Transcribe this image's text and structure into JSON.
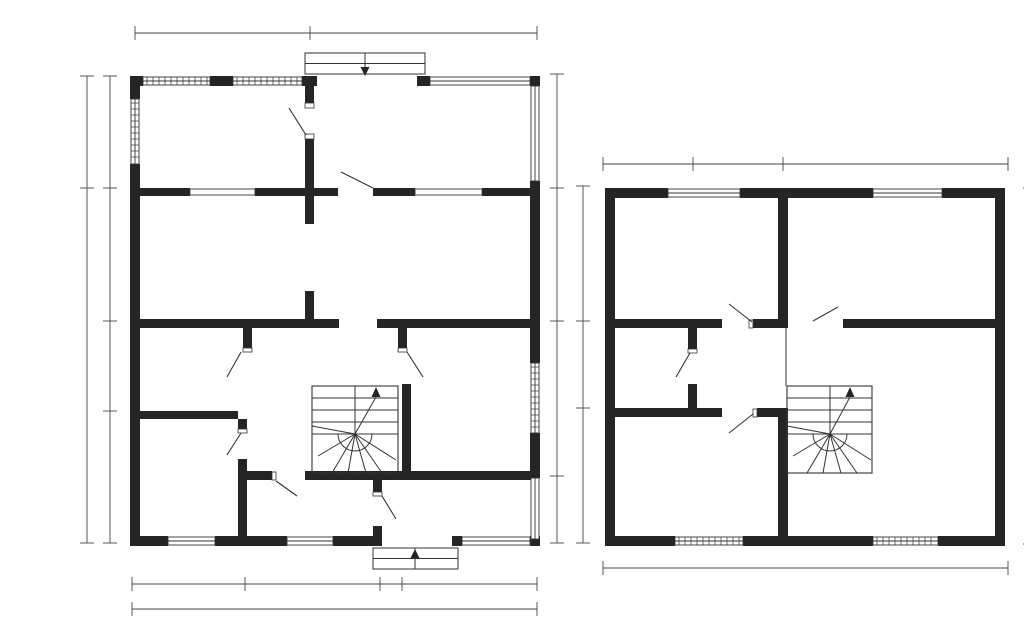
{
  "meta": {
    "caption": "Floor plans"
  },
  "drawing": {
    "canvas": {
      "width": 1024,
      "height": 608
    },
    "colors": {
      "background": "#ffffff",
      "wall": "#252525",
      "thin": "#333333",
      "dim": "#454545"
    }
  },
  "plans": [
    {
      "id": "ground-floor",
      "label": "Ground floor plan",
      "walls": [
        [
          90,
          60,
          13,
          10
        ],
        [
          170,
          60,
          23,
          10
        ],
        [
          262,
          60,
          15,
          10
        ],
        [
          377,
          60,
          13,
          10
        ],
        [
          490,
          60,
          10,
          10
        ],
        [
          90,
          60,
          10,
          23
        ],
        [
          90,
          148,
          10,
          382
        ],
        [
          490,
          165,
          10,
          182
        ],
        [
          490,
          417,
          10,
          45
        ],
        [
          490,
          523,
          10,
          7
        ],
        [
          90,
          520,
          38,
          10
        ],
        [
          175,
          520,
          72,
          10
        ],
        [
          293,
          520,
          49,
          10
        ],
        [
          333,
          510,
          9,
          10
        ],
        [
          412,
          520,
          10,
          10
        ],
        [
          490,
          520,
          10,
          10
        ],
        [
          93,
          172,
          57,
          8
        ],
        [
          215,
          172,
          83,
          8
        ],
        [
          333,
          172,
          42,
          8
        ],
        [
          442,
          172,
          55,
          8
        ],
        [
          265,
          70,
          9,
          17
        ],
        [
          265,
          123,
          9,
          49
        ],
        [
          265,
          180,
          9,
          28
        ],
        [
          265,
          275,
          9,
          28
        ],
        [
          93,
          303,
          206,
          9
        ],
        [
          337,
          303,
          156,
          9
        ],
        [
          203,
          312,
          9,
          20
        ],
        [
          358,
          312,
          9,
          20
        ],
        [
          93,
          395,
          105,
          8
        ],
        [
          198,
          403,
          9,
          10
        ],
        [
          198,
          443,
          9,
          87
        ],
        [
          207,
          455,
          25,
          9
        ],
        [
          265,
          455,
          232,
          9
        ],
        [
          333,
          464,
          9,
          12
        ],
        [
          362,
          368,
          9,
          87
        ]
      ],
      "windows": [
        {
          "rect": [
            103,
            61,
            67,
            8
          ],
          "o": "h",
          "hatch": true
        },
        {
          "rect": [
            193,
            61,
            69,
            8
          ],
          "o": "h",
          "hatch": true
        },
        {
          "rect": [
            390,
            61,
            100,
            8
          ],
          "o": "h",
          "hatch": false
        },
        {
          "rect": [
            91,
            83,
            8,
            65
          ],
          "o": "v",
          "hatch": true
        },
        {
          "rect": [
            491,
            70,
            8,
            95
          ],
          "o": "v",
          "hatch": false
        },
        {
          "rect": [
            491,
            347,
            8,
            70
          ],
          "o": "v",
          "hatch": true
        },
        {
          "rect": [
            491,
            462,
            8,
            61
          ],
          "o": "v",
          "hatch": false
        },
        {
          "rect": [
            128,
            521,
            47,
            8
          ],
          "o": "h",
          "hatch": false
        },
        {
          "rect": [
            247,
            521,
            46,
            8
          ],
          "o": "h",
          "hatch": false
        },
        {
          "rect": [
            422,
            521,
            68,
            8
          ],
          "o": "h",
          "hatch": false
        },
        {
          "rect": [
            150,
            173,
            65,
            6
          ],
          "o": "h",
          "hatch": false,
          "slot": true
        },
        {
          "rect": [
            375,
            173,
            67,
            6
          ],
          "o": "h",
          "hatch": false,
          "slot": true
        }
      ],
      "sills": [
        [
          265,
          87,
          9,
          5
        ],
        [
          265,
          118,
          9,
          5
        ],
        [
          203,
          332,
          9,
          4
        ],
        [
          358,
          332,
          9,
          4
        ],
        [
          198,
          413,
          9,
          4
        ],
        [
          232,
          456,
          4,
          8
        ],
        [
          333,
          476,
          9,
          4
        ]
      ],
      "door_swings": [
        [
          266,
          119,
          249,
          92
        ],
        [
          333,
          172,
          301,
          156
        ],
        [
          201,
          336,
          187,
          361
        ],
        [
          367,
          336,
          383,
          361
        ],
        [
          201,
          417,
          187,
          439
        ],
        [
          236,
          465,
          257,
          480
        ],
        [
          342,
          480,
          356,
          503
        ]
      ],
      "thin_lines": [],
      "stairs": {
        "box": [
          272,
          370,
          86,
          87
        ],
        "divider": [
          315,
          370,
          315,
          418
        ],
        "treads_y": [
          382,
          394,
          406,
          418
        ],
        "tread_x": [
          272,
          358
        ],
        "center": [
          315,
          418
        ],
        "arc_r": 17,
        "fan": [
          [
            272,
            410
          ],
          [
            278,
            440
          ],
          [
            292,
            457
          ],
          [
            308,
            457
          ],
          [
            326,
            457
          ],
          [
            342,
            457
          ],
          [
            356,
            444
          ]
        ],
        "arrow": {
          "stem": [
            315,
            418,
            336,
            381
          ],
          "tip": [
            336,
            371
          ]
        }
      },
      "porches": [
        {
          "box": [
            265,
            37,
            120,
            21
          ],
          "divider_x": 325,
          "arrow_tip": [
            325,
            60
          ],
          "arrow_dir": "down"
        },
        {
          "box": [
            333,
            532,
            85,
            21
          ],
          "divider_x": 375,
          "arrow_tip": [
            375,
            533
          ],
          "arrow_dir": "up"
        }
      ],
      "dimensions": [
        {
          "p1": [
            95,
            17
          ],
          "p2": [
            497,
            17
          ],
          "axis": "x",
          "ticks": [
            95,
            270,
            497
          ]
        },
        {
          "p1": [
            47,
            60
          ],
          "p2": [
            47,
            527
          ],
          "axis": "y",
          "ticks": [
            60,
            172,
            527
          ]
        },
        {
          "p1": [
            70,
            60
          ],
          "p2": [
            70,
            527
          ],
          "axis": "y",
          "ticks": [
            60,
            172,
            305,
            395,
            527
          ]
        },
        {
          "p1": [
            517,
            58
          ],
          "p2": [
            517,
            527
          ],
          "axis": "y",
          "ticks": [
            58,
            172,
            305,
            460,
            527
          ]
        },
        {
          "p1": [
            92,
            568
          ],
          "p2": [
            497,
            568
          ],
          "axis": "x",
          "ticks": [
            92,
            205,
            340,
            362,
            497
          ]
        },
        {
          "p1": [
            92,
            593
          ],
          "p2": [
            497,
            593
          ],
          "axis": "x",
          "ticks": [
            92,
            497
          ]
        }
      ]
    },
    {
      "id": "upper-floor",
      "label": "Upper floor plan",
      "walls": [
        [
          565,
          172,
          63,
          10
        ],
        [
          700,
          172,
          133,
          10
        ],
        [
          902,
          172,
          63,
          10
        ],
        [
          565,
          172,
          10,
          358
        ],
        [
          955,
          172,
          10,
          358
        ],
        [
          565,
          520,
          70,
          10
        ],
        [
          703,
          520,
          130,
          10
        ],
        [
          898,
          520,
          67,
          10
        ],
        [
          738,
          182,
          10,
          130
        ],
        [
          575,
          303,
          107,
          9
        ],
        [
          713,
          303,
          35,
          9
        ],
        [
          803,
          303,
          152,
          9
        ],
        [
          648,
          312,
          9,
          21
        ],
        [
          648,
          368,
          9,
          27
        ],
        [
          575,
          392,
          107,
          9
        ],
        [
          717,
          392,
          31,
          9
        ],
        [
          738,
          392,
          10,
          138
        ]
      ],
      "windows": [
        {
          "rect": [
            628,
            173,
            72,
            8
          ],
          "o": "h",
          "hatch": false
        },
        {
          "rect": [
            833,
            173,
            69,
            8
          ],
          "o": "h",
          "hatch": false
        },
        {
          "rect": [
            635,
            521,
            68,
            8
          ],
          "o": "h",
          "hatch": true
        },
        {
          "rect": [
            833,
            521,
            65,
            8
          ],
          "o": "h",
          "hatch": true
        }
      ],
      "sills": [
        [
          709,
          304,
          4,
          8
        ],
        [
          648,
          333,
          9,
          4
        ],
        [
          713,
          393,
          4,
          8
        ]
      ],
      "door_swings": [
        [
          712,
          306,
          689,
          288
        ],
        [
          773,
          305,
          798,
          291
        ],
        [
          650,
          337,
          636,
          361
        ],
        [
          713,
          398,
          689,
          417
        ]
      ],
      "thin_lines": [
        [
          746,
          312,
          746,
          370
        ]
      ],
      "stairs": {
        "box": [
          747,
          370,
          85,
          87
        ],
        "divider": [
          790,
          370,
          790,
          418
        ],
        "treads_y": [
          382,
          394,
          406,
          418
        ],
        "tread_x": [
          747,
          832
        ],
        "center": [
          790,
          418
        ],
        "arc_r": 17,
        "fan": [
          [
            747,
            410
          ],
          [
            753,
            440
          ],
          [
            767,
            457
          ],
          [
            783,
            457
          ],
          [
            801,
            457
          ],
          [
            817,
            457
          ],
          [
            831,
            444
          ]
        ],
        "arrow": {
          "stem": [
            790,
            418,
            810,
            381
          ],
          "tip": [
            810,
            371
          ]
        }
      },
      "porches": [],
      "dimensions": [
        {
          "p1": [
            563,
            148
          ],
          "p2": [
            968,
            148
          ],
          "axis": "x",
          "ticks": [
            563,
            653,
            743,
            968
          ]
        },
        {
          "p1": [
            543,
            170
          ],
          "p2": [
            543,
            527
          ],
          "axis": "y",
          "ticks": [
            170,
            305,
            392,
            527
          ]
        },
        {
          "p1": [
            990,
            172
          ],
          "p2": [
            990,
            528
          ],
          "axis": "y",
          "ticks": [
            172,
            528
          ]
        },
        {
          "p1": [
            563,
            552
          ],
          "p2": [
            968,
            552
          ],
          "axis": "x",
          "ticks": [
            563,
            968
          ]
        }
      ]
    }
  ]
}
